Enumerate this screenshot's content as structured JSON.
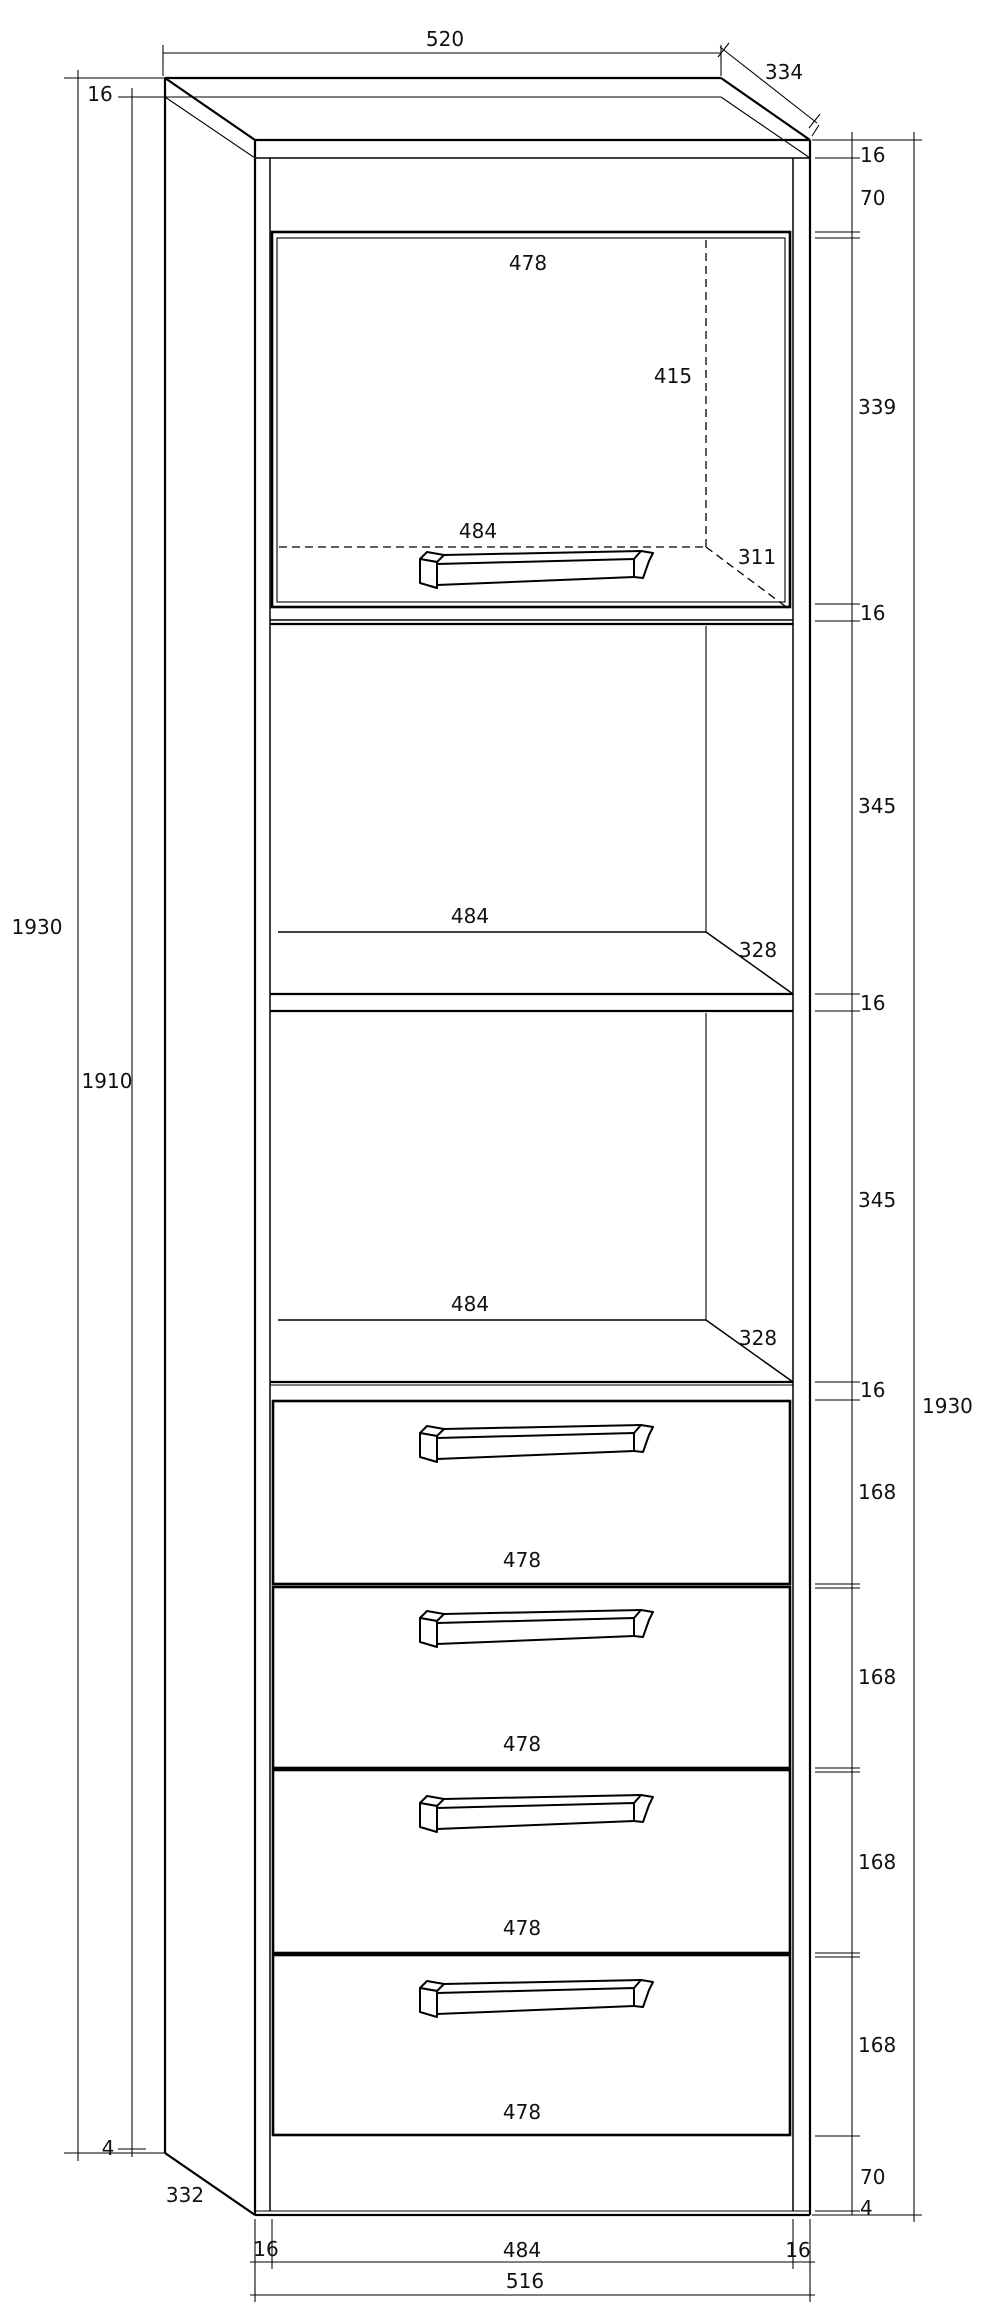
{
  "drawing_title": "cabinet-technical-drawing",
  "unit": "mm",
  "labels": {
    "top_width": "520",
    "top_depth": "334",
    "left_top_thickness": "16",
    "left_overall_height": "1930",
    "left_inner_height": "1910",
    "left_bottom_gap": "4",
    "left_bottom_depth": "332",
    "door_width": "478",
    "door_inner_height": "415",
    "door_inner_width": "484",
    "door_inner_depth": "311",
    "right_top_thickness": "16",
    "right_top_offset": "70",
    "right_door_opening": "339",
    "right_divider_1": "16",
    "right_shelf_opening_1": "345",
    "right_divider_2": "16",
    "right_shelf_opening_2": "345",
    "right_divider_3": "16",
    "right_drawer_1": "168",
    "right_drawer_2": "168",
    "right_drawer_3": "168",
    "right_drawer_4": "168",
    "right_plinth": "70",
    "right_bottom_gap": "4",
    "right_overall_height": "1930",
    "shelf1_width": "484",
    "shelf1_depth": "328",
    "shelf2_width": "484",
    "shelf2_depth": "328",
    "drawer1_width": "478",
    "drawer2_width": "478",
    "drawer3_width": "478",
    "drawer4_width": "478",
    "bottom_left_thickness": "16",
    "bottom_inner_width": "484",
    "bottom_right_thickness": "16",
    "bottom_carcass_width": "516"
  }
}
